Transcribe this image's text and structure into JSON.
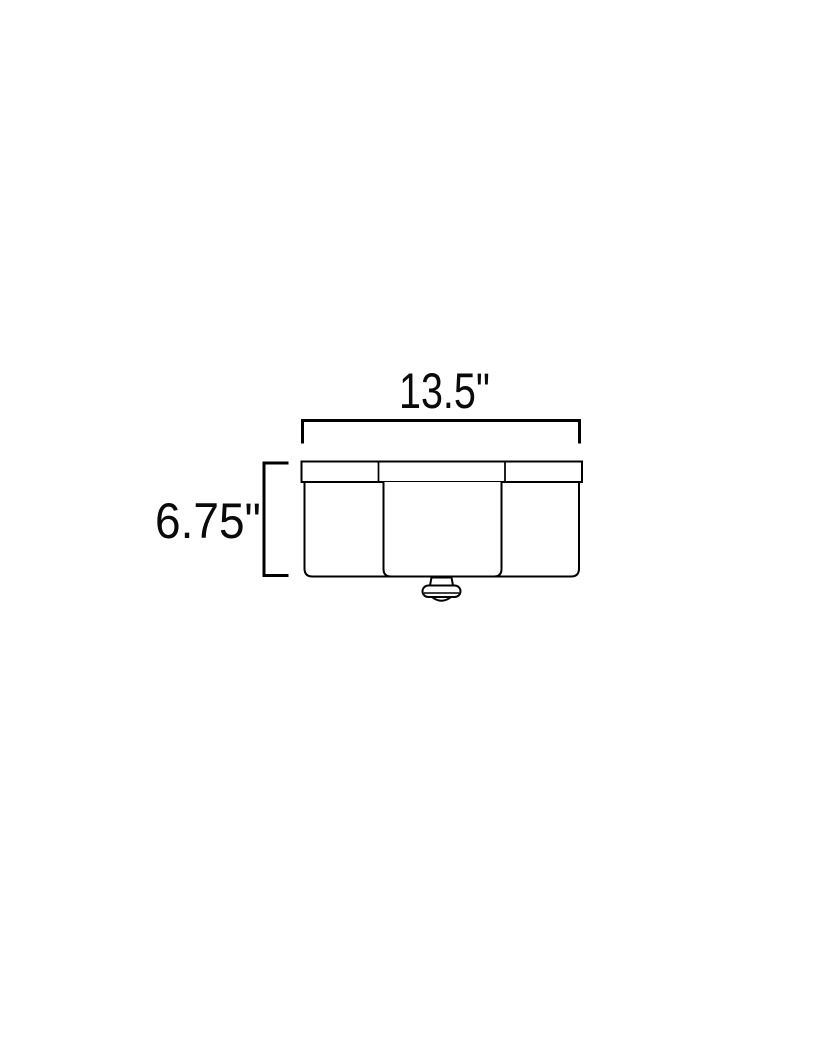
{
  "diagram": {
    "type": "product-dimension-drawing",
    "subject": "flush-mount-ceiling-light",
    "background_color": "#ffffff",
    "line_color": "#000000",
    "width_dimension": {
      "label": "13.5\""
    },
    "height_dimension": {
      "label": "6.75\""
    }
  }
}
